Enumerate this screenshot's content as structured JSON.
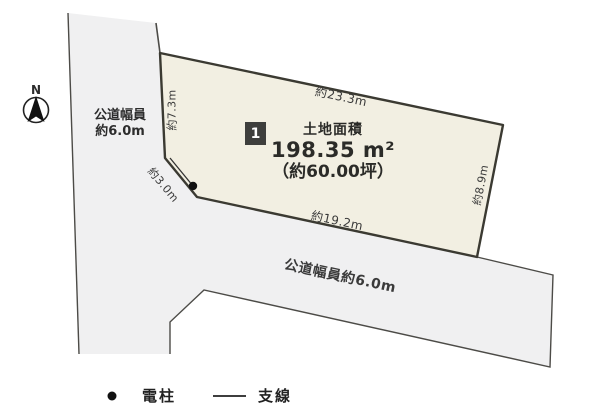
{
  "title": "土地区画図",
  "compass": {
    "north": "N"
  },
  "roads": {
    "vertical": {
      "line1": "公道幅員",
      "line2": "約6.0m"
    },
    "horizontal_label": "公道幅員約6.0m"
  },
  "parcel": {
    "badge": "1",
    "area_title": "土地面積",
    "area_m2": "198.35 m²",
    "area_tsubo": "（約60.00坪）",
    "dims": {
      "top": "約23.3m",
      "left": "約7.3m",
      "diagonal": "約3.0m",
      "bottom": "約19.2m",
      "right": "約8.9m"
    }
  },
  "legend": {
    "pole_symbol": "dot-icon",
    "pole_label": "電柱",
    "wire_symbol": "line-icon",
    "wire_label": "支線"
  },
  "colors": {
    "parcel_fill": "#f2efe2",
    "parcel_outline": "#3b3a32",
    "road_fill": "#f0f0f1",
    "road_outline": "#4c4b47",
    "badge_bg": "#3e3e3c",
    "text": "#2d2d2d"
  }
}
